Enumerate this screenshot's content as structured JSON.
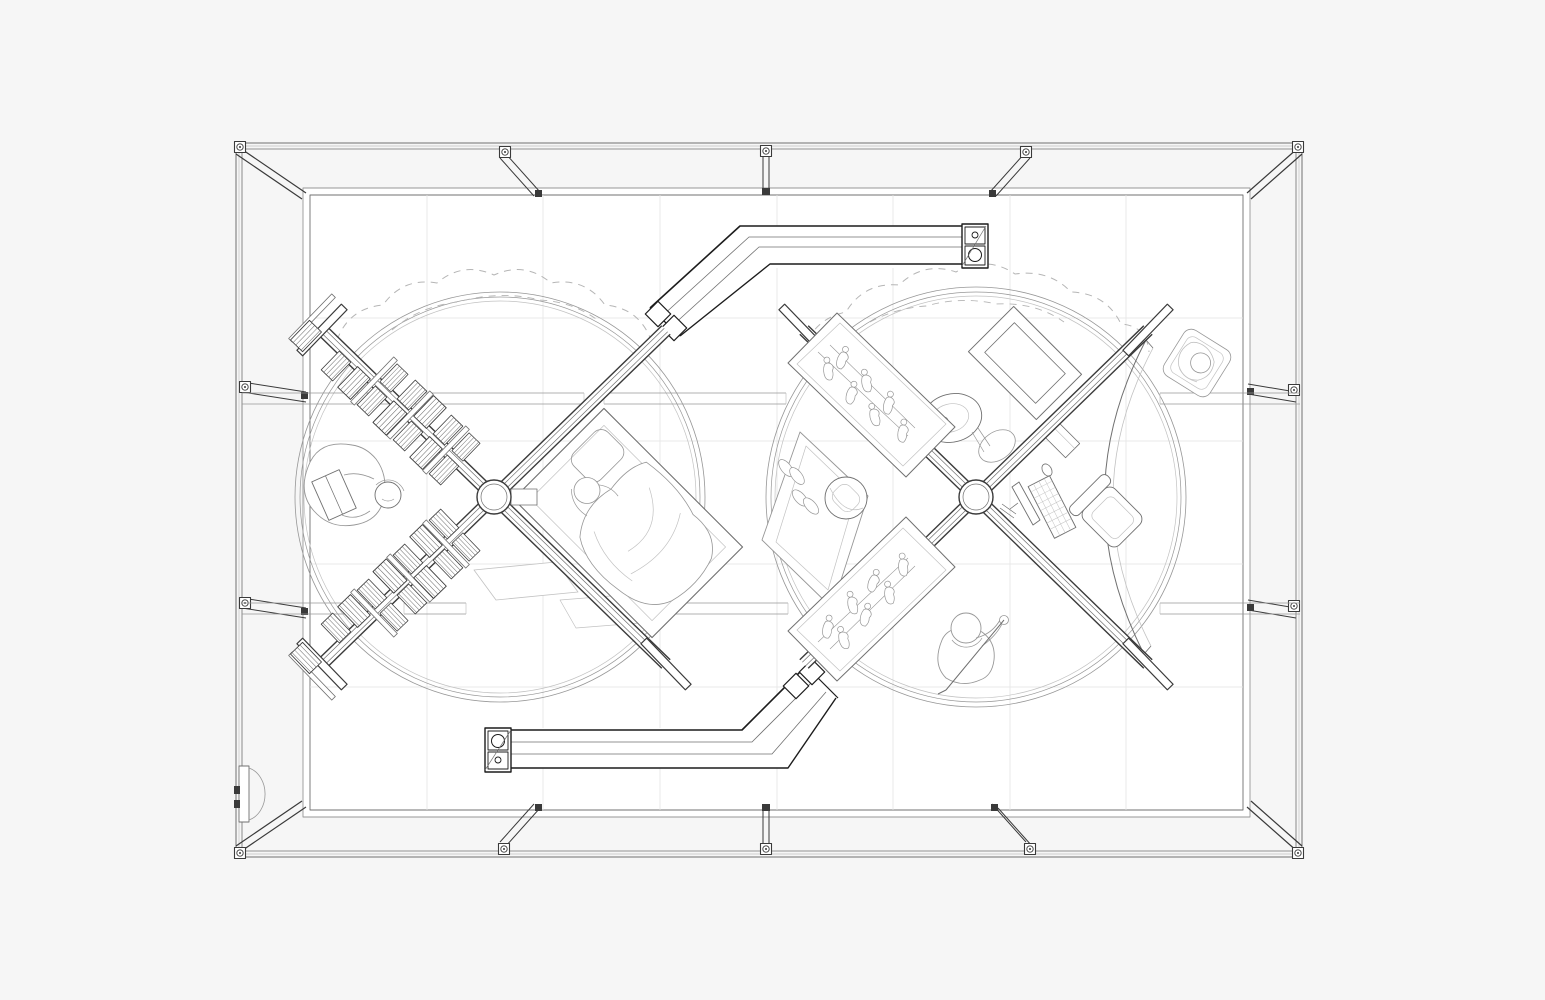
{
  "colors": {
    "canvas_bg": "#f6f6f6",
    "pattern_line": "#ececec",
    "pattern_fill": "#fbfbfb",
    "floor_fill": "#ffffff",
    "grid_line": "#e4e4e4",
    "line_dark": "#3a3a3a",
    "line_mid": "#707070",
    "line_light": "#979797",
    "line_faint": "#c2c2c2",
    "duct": "#1c1c1c",
    "canopy": "#b5b5b5"
  },
  "scene": {
    "kind": "architectural-axonometric-line-drawing",
    "elements": [
      {
        "name": "pavilion-frame",
        "label": "Rectangular frame with corner braces, posts and tie beams"
      },
      {
        "name": "entry-door",
        "label": "Entry door with swing arc"
      },
      {
        "name": "floor-slab",
        "label": "Raised floor slab with tile grid"
      },
      {
        "name": "left-rotunda",
        "label": "Left circular zone with dashed canopy outline"
      },
      {
        "name": "right-rotunda",
        "label": "Right circular zone with dashed canopy outline"
      },
      {
        "name": "upper-duct",
        "label": "Upper angled gallery duct with end cap"
      },
      {
        "name": "lower-duct",
        "label": "Lower angled gallery duct with end cap"
      },
      {
        "name": "left-cross-gallery",
        "label": "Cross-shaped bookshelf walls with book stacks"
      },
      {
        "name": "reading-person",
        "label": "Person reading a book in a beanbag"
      },
      {
        "name": "bed",
        "label": "Bed with pillow and sleeping person"
      },
      {
        "name": "side-tables",
        "label": "Low side tables"
      },
      {
        "name": "right-cross-gallery",
        "label": "Cross-shaped display walls with figurines"
      },
      {
        "name": "media-frame",
        "label": "Framed flat screen"
      },
      {
        "name": "turntable",
        "label": "Turntable with horn"
      },
      {
        "name": "desk-setup",
        "label": "Desk with monitor, keyboard and mouse"
      },
      {
        "name": "office-chair",
        "label": "Office chair"
      },
      {
        "name": "rug",
        "label": "Rug with slippers and pouf"
      },
      {
        "name": "golfing-person",
        "label": "Person swinging a club"
      },
      {
        "name": "seated-person",
        "label": "Seated person in armchair"
      },
      {
        "name": "curved-screen",
        "label": "Curved screen wall"
      }
    ]
  }
}
